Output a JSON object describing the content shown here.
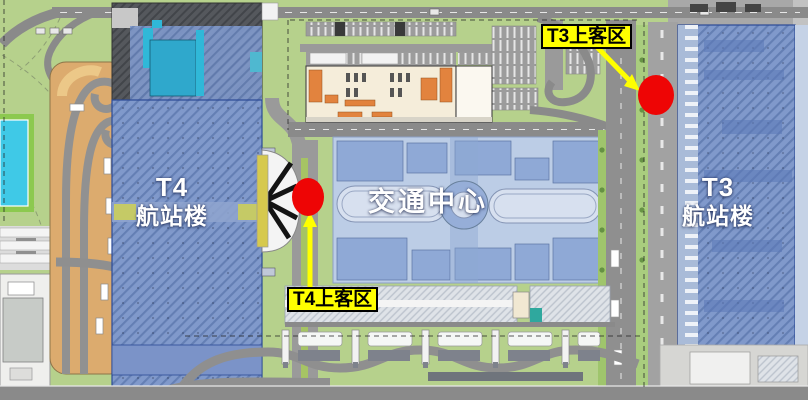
{
  "areas": {
    "t4_terminal": {
      "line1": "T4",
      "line2": "航站楼"
    },
    "transport_center": {
      "label": "交通中心"
    },
    "t3_terminal": {
      "line1": "T3",
      "line2": "航站楼"
    }
  },
  "pickup_tags": {
    "t3": {
      "label": "T3上客区"
    },
    "t4": {
      "label": "T4上客区"
    }
  },
  "colors": {
    "grass": "#b6d18c",
    "road": "#8a8a8a",
    "terminal_blue": "#8099cb",
    "terminal_border": "#2c4a96",
    "transport_center_blue": "#bccde6",
    "ramp_orange": "#dcab6e",
    "station_cream": "#f5edda",
    "station_orange": "#e2833e",
    "marker_red": "#ee0505",
    "tag_yellow": "#ffff00",
    "pool_cyan": "#3fc9e7"
  }
}
